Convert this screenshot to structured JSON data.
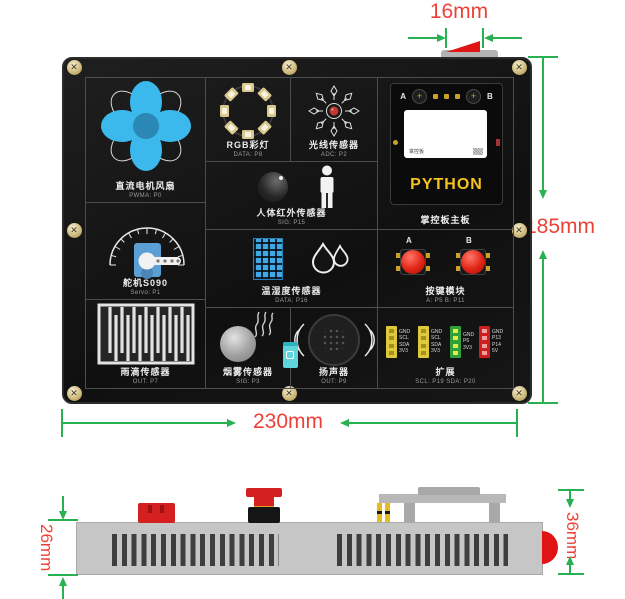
{
  "dims": {
    "top": "16mm",
    "right": "185mm",
    "bottom": "230mm",
    "side_left": "26mm",
    "side_right": "36mm"
  },
  "colors": {
    "dimension_line": "#28b052",
    "dimension_text": "#ed4138",
    "board": "#141414",
    "fan_blade": "#3cb9ec",
    "accent_red": "#e01414",
    "python_gold": "#f4c31d"
  },
  "board": {
    "fan": {
      "label": "直流电机风扇",
      "port": "PWMA: P0"
    },
    "rgb": {
      "label": "RGB彩灯",
      "port": "DATA: P8"
    },
    "light": {
      "label": "光线传感器",
      "port": "ADC: P2"
    },
    "main": {
      "label": "掌控板主板",
      "btn_a": "A",
      "btn_b": "B",
      "logo": "掌控板",
      "python": "PYTHON"
    },
    "pir": {
      "label": "人体红外传感器",
      "port": "SIG: P15"
    },
    "servo": {
      "label": "舵机S090",
      "port": "Servo: P1"
    },
    "dht": {
      "label": "温湿度传感器",
      "port": "DATA: P16"
    },
    "keys": {
      "label": "按键模块",
      "port": "A: P5  B: P11",
      "a": "A",
      "b": "B"
    },
    "rain": {
      "label": "雨滴传感器",
      "port": "OUT: P7"
    },
    "smoke": {
      "label": "烟雾传感器",
      "port": "SIG: P3"
    },
    "speaker": {
      "label": "扬声器",
      "port": "OUT: P9"
    },
    "expand": {
      "label": "扩展",
      "port": "SCL: P19  SDA: P20",
      "connectors": [
        {
          "color": "#ddc93c",
          "pins": [
            "GND",
            "SCL",
            "SDA",
            "3V3"
          ]
        },
        {
          "color": "#ddc93c",
          "pins": [
            "GND",
            "SCL",
            "SDA",
            "3V3"
          ]
        },
        {
          "color": "#2fa23b",
          "pins": [
            "GND",
            "P6",
            "3V3"
          ]
        },
        {
          "color": "#cc2020",
          "pins": [
            "GND",
            "P13",
            "P14",
            "5V"
          ]
        }
      ]
    }
  }
}
